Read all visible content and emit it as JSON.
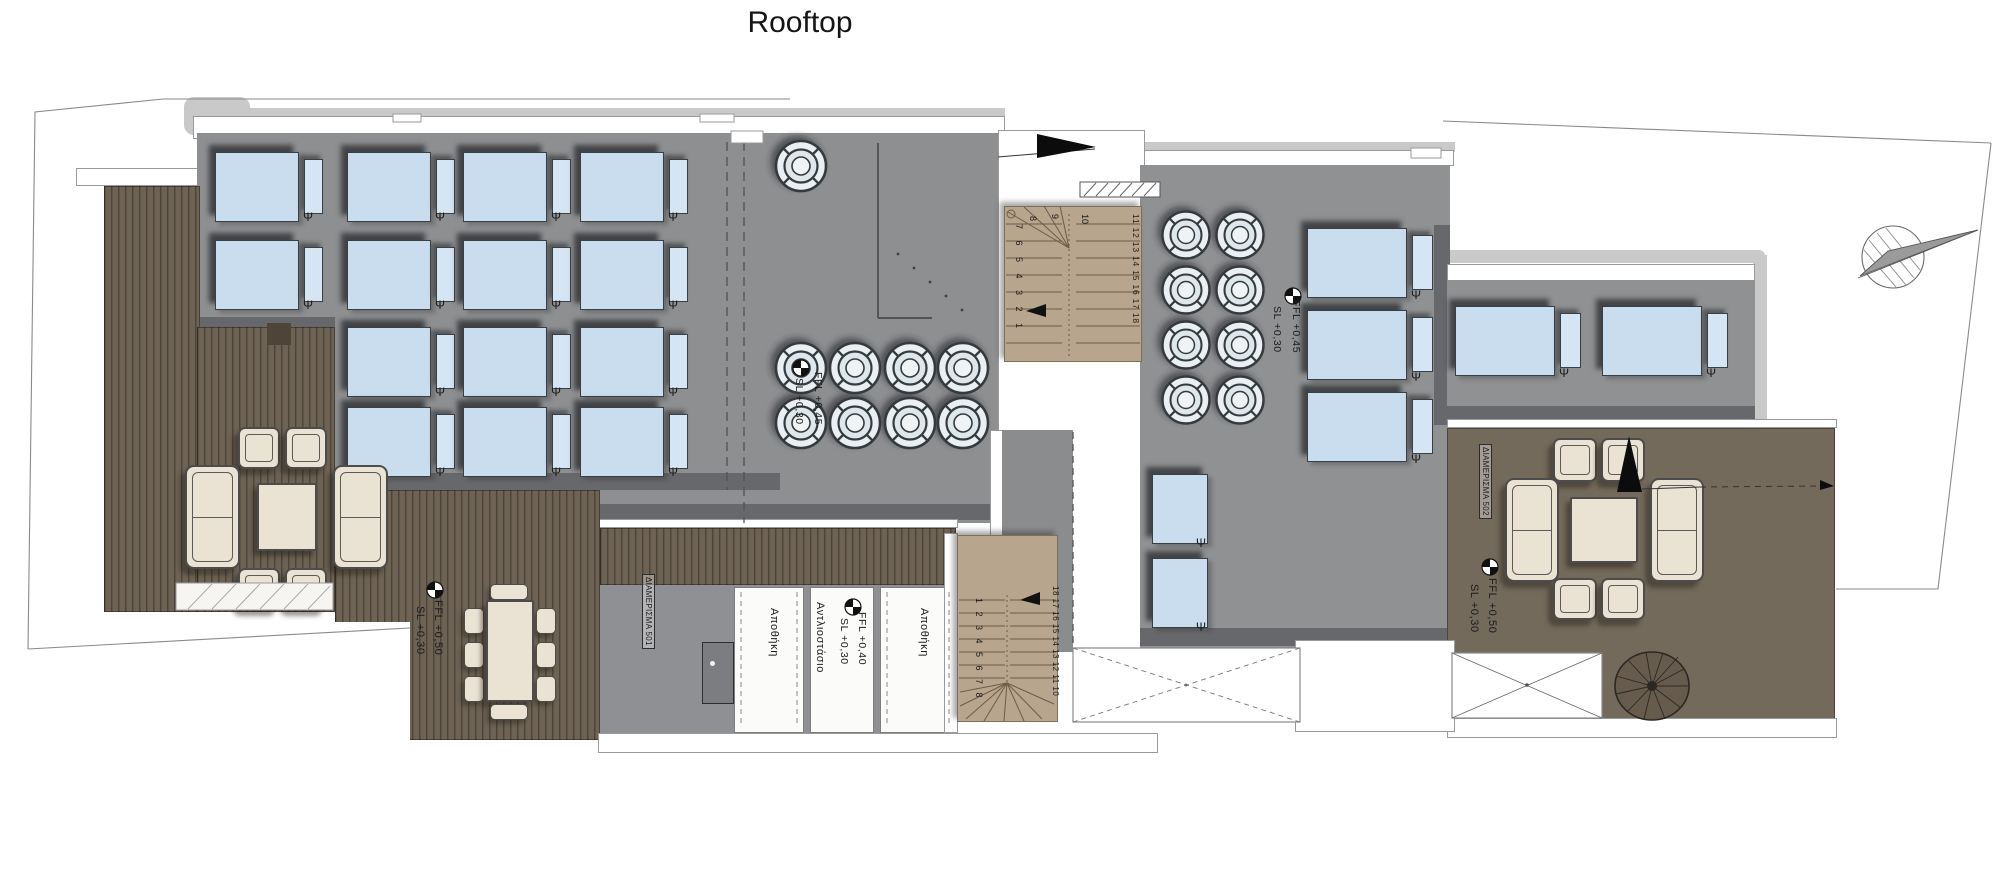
{
  "title": "Rooftop",
  "symbols": {
    "panel": "Ψ"
  },
  "apartments": {
    "a501": "ΔΙΑΜΕΡΙΣΜΑ 501",
    "a502": "ΔΙΑΜΕΡΙΣΜΑ 502"
  },
  "rooms": {
    "storage_left": "Αποθήκη",
    "pump_room": "Αντλιοστάσιο",
    "storage_right": "Αποθήκη"
  },
  "levels": {
    "left_deck": {
      "ffl": "FFL +0,50",
      "sl": "SL +0,30"
    },
    "mid_vents": {
      "ffl": "FFL +0,45",
      "sl": "SL +0,30"
    },
    "pump_room": {
      "ffl": "FFL +0,40",
      "sl": "SL +0,30"
    },
    "right_vents": {
      "ffl": "FFL +0,45",
      "sl": "SL +0,30"
    },
    "right_deck": {
      "ffl": "FFL +0,50",
      "sl": "SL +0,30"
    }
  },
  "stairs": {
    "upper": {
      "left": "7 6 5 4 3 2 1",
      "turn_a": "8",
      "turn_b": "9",
      "turn_c": "10",
      "right": "11 12 13 14 15 16 17 18"
    },
    "lower": {
      "left": "1 2 3 4 5 6 7 8",
      "right": "18 17 16 15 14 13 12 11 10"
    }
  },
  "colors": {
    "roof_gray": "#8e8f91",
    "deck_brown": "#6d6254",
    "panel_blue": "#c9ddef",
    "stair_tan": "#b7a58d",
    "vent_fill": "#e9eff2"
  }
}
